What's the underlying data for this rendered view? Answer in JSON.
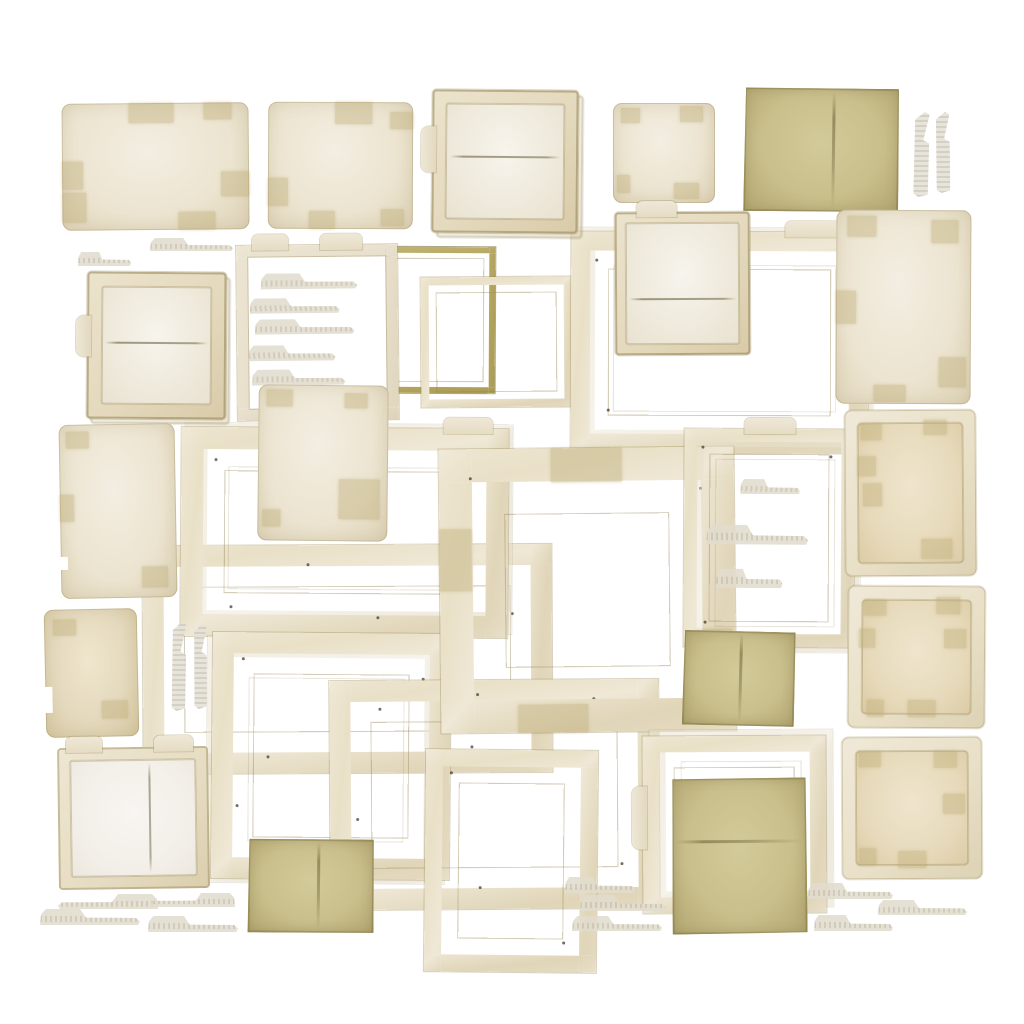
{
  "palette": {
    "white": "#ffffff",
    "cream": "#ece4d0",
    "cream-light": "#f3eee2",
    "cream-dark": "#ddd2b6",
    "tan": "#e4d9bd",
    "pale": "#f5f2ea",
    "olive": "#c9bf8c",
    "olive-dark": "#a89b60",
    "tape": "#bca973",
    "edge": "#98895a",
    "speck": "#3f3826"
  },
  "canvas": {
    "width": 1024,
    "height": 1024
  },
  "items": [
    {
      "id": "frame-wide-left",
      "t": "frame",
      "x": 143,
      "y": 545,
      "w": 367,
      "h": 186,
      "r": -0.3,
      "bw": 21,
      "specks": [
        [
          6,
          20
        ],
        [
          40,
          8
        ],
        [
          90,
          30
        ],
        [
          30,
          92
        ],
        [
          80,
          88
        ]
      ]
    },
    {
      "id": "frame-landscape-mid",
      "t": "frame",
      "x": 181,
      "y": 428,
      "w": 283,
      "h": 165,
      "r": 0.4,
      "bw": 22,
      "tt": [
        [
          80,
          15
        ]
      ],
      "stack": [
        4,
        -4
      ],
      "specks": [
        [
          10,
          15
        ],
        [
          85,
          10
        ],
        [
          15,
          85
        ],
        [
          60,
          90
        ]
      ]
    },
    {
      "id": "frame-square-lower-left",
      "t": "frame",
      "x": 212,
      "y": 633,
      "w": 196,
      "h": 204,
      "r": 0.5,
      "bw": 21,
      "stack": [
        -5,
        4
      ],
      "specks": [
        [
          12,
          10
        ],
        [
          88,
          18
        ],
        [
          10,
          70
        ],
        [
          55,
          92
        ]
      ]
    },
    {
      "id": "frame-landscape-lower",
      "t": "frame",
      "x": 330,
      "y": 680,
      "w": 287,
      "h": 187,
      "r": -0.4,
      "bw": 21,
      "specks": [
        [
          15,
          12
        ],
        [
          80,
          8
        ],
        [
          8,
          60
        ],
        [
          88,
          80
        ],
        [
          45,
          90
        ]
      ]
    },
    {
      "id": "frame-portrait-lower",
      "t": "frame",
      "x": 425,
      "y": 750,
      "w": 138,
      "h": 188,
      "r": 0.6,
      "bw": 17,
      "specks": [
        [
          14,
          10
        ],
        [
          80,
          86
        ]
      ]
    },
    {
      "id": "frame-thin-olive",
      "t": "frame",
      "x": 384,
      "y": 247,
      "w": 99,
      "h": 134,
      "r": 0.3,
      "bw": 6,
      "tone": "olive"
    },
    {
      "id": "frame-thin-cream",
      "t": "frame",
      "x": 421,
      "y": 277,
      "w": 135,
      "h": 114,
      "r": -0.4,
      "bw": 8
    },
    {
      "id": "frame-top-center",
      "t": "frame",
      "x": 571,
      "y": 232,
      "w": 259,
      "h": 183,
      "r": 0.2,
      "bw": 19,
      "tt": [
        [
          72,
          19
        ]
      ],
      "stack": [
        5,
        -4
      ],
      "specks": [
        [
          8,
          12
        ],
        [
          90,
          20
        ],
        [
          12,
          80
        ],
        [
          70,
          92
        ],
        [
          94,
          70
        ]
      ]
    },
    {
      "id": "frame-wide-border",
      "t": "frame",
      "x": 440,
      "y": 448,
      "w": 229,
      "h": 218,
      "r": -0.6,
      "bw": 33,
      "patches": [
        [
          38,
          0,
          24,
          12
        ],
        [
          0,
          28,
          11,
          22
        ],
        [
          84,
          64,
          15,
          20
        ],
        [
          26,
          90,
          24,
          10
        ]
      ],
      "specks": [
        [
          10,
          10
        ],
        [
          88,
          14
        ],
        [
          12,
          86
        ],
        [
          86,
          84
        ]
      ]
    },
    {
      "id": "frame-portrait-tabs",
      "t": "frame",
      "x": 684,
      "y": 429,
      "w": 144,
      "h": 192,
      "r": 0.3,
      "bw": 13,
      "tt": [
        [
          35,
          30
        ]
      ],
      "stack": [
        6,
        5
      ],
      "strips": [
        [
          33,
          23,
          35,
          7
        ],
        [
          13,
          44,
          60,
          9
        ],
        [
          19,
          64,
          39,
          9
        ]
      ],
      "specks": [
        [
          10,
          8
        ],
        [
          85,
          12
        ],
        [
          12,
          88
        ]
      ]
    },
    {
      "id": "frame-folder-stack",
      "t": "frame",
      "x": 643,
      "y": 736,
      "w": 151,
      "h": 145,
      "r": -0.3,
      "bw": 16,
      "st": [
        28,
        36
      ],
      "stack": [
        7,
        -6
      ]
    },
    {
      "id": "card-top-1",
      "t": "card",
      "x": 62,
      "y": 103,
      "w": 187,
      "h": 127,
      "r": -0.5,
      "patches": [
        [
          36,
          0,
          24,
          16
        ],
        [
          76,
          0,
          15,
          13
        ],
        [
          0,
          46,
          11,
          22
        ],
        [
          0,
          70,
          13,
          24
        ],
        [
          85,
          54,
          15,
          20
        ],
        [
          62,
          86,
          20,
          14
        ]
      ]
    },
    {
      "id": "card-top-2",
      "t": "card",
      "x": 268,
      "y": 102,
      "w": 145,
      "h": 127,
      "r": 0.2,
      "patches": [
        [
          46,
          0,
          26,
          17
        ],
        [
          84,
          8,
          16,
          13
        ],
        [
          0,
          60,
          14,
          22
        ],
        [
          28,
          86,
          18,
          14
        ],
        [
          78,
          84,
          16,
          14
        ]
      ]
    },
    {
      "id": "pocket-folder-top",
      "t": "pocket",
      "x": 432,
      "y": 90,
      "w": 146,
      "h": 143,
      "r": 0.5,
      "pw": 14,
      "crease": 45,
      "st": [
        26,
        32
      ],
      "stack": [
        5,
        5
      ]
    },
    {
      "id": "card-top-3",
      "t": "card",
      "x": 613,
      "y": 103,
      "w": 102,
      "h": 100,
      "r": 0,
      "patches": [
        [
          8,
          5,
          18,
          15
        ],
        [
          66,
          3,
          22,
          16
        ],
        [
          4,
          72,
          13,
          18
        ],
        [
          60,
          80,
          24,
          16
        ]
      ]
    },
    {
      "id": "paper-olive-top",
      "t": "paper",
      "x": 744,
      "y": 88,
      "w": 155,
      "h": 124,
      "r": 0.8,
      "fold": [
        "v",
        57
      ]
    },
    {
      "id": "vtab-top-1",
      "t": "vtab",
      "x": 914,
      "y": 112,
      "w": 15,
      "h": 85,
      "r": 1
    },
    {
      "id": "vtab-top-2",
      "t": "vtab",
      "x": 936,
      "y": 112,
      "w": 14,
      "h": 81,
      "r": -1
    },
    {
      "id": "tab-upper-1",
      "t": "tab",
      "x": 150,
      "y": 238,
      "w": 83,
      "h": 13,
      "r": 0
    },
    {
      "id": "tab-upper-2",
      "t": "tab",
      "x": 78,
      "y": 252,
      "w": 53,
      "h": 14,
      "r": 0
    },
    {
      "id": "pocket-folder-left",
      "t": "pocket",
      "x": 87,
      "y": 272,
      "w": 139,
      "h": 147,
      "r": 0.4,
      "pw": 15,
      "crease": 47,
      "st": [
        30,
        28
      ],
      "stack": [
        4,
        5
      ]
    },
    {
      "id": "doc-tab-sheet",
      "t": "doc",
      "x": 237,
      "y": 245,
      "w": 137,
      "h": 151,
      "r": -0.6,
      "bw": 12,
      "tt": [
        [
          10,
          22
        ],
        [
          52,
          26
        ]
      ],
      "strips": [
        [
          15,
          16,
          60,
          9
        ],
        [
          8,
          30,
          56,
          9
        ],
        [
          11,
          42,
          62,
          9
        ],
        [
          7,
          57,
          54,
          9
        ],
        [
          9,
          71,
          58,
          9
        ]
      ]
    },
    {
      "id": "pocket-folder-center",
      "t": "pocket",
      "x": 615,
      "y": 212,
      "w": 135,
      "h": 143,
      "r": -0.3,
      "pw": 11,
      "crease": 62,
      "tt": [
        [
          16,
          30
        ]
      ]
    },
    {
      "id": "card-right-portrait",
      "t": "card",
      "x": 836,
      "y": 210,
      "w": 135,
      "h": 194,
      "r": 0.3,
      "patches": [
        [
          8,
          3,
          22,
          11
        ],
        [
          70,
          5,
          20,
          12
        ],
        [
          0,
          42,
          15,
          17
        ],
        [
          76,
          76,
          20,
          15
        ],
        [
          28,
          90,
          24,
          9
        ]
      ]
    },
    {
      "id": "card-mid-left",
      "t": "card",
      "x": 60,
      "y": 424,
      "w": 116,
      "h": 174,
      "r": -1,
      "patches": [
        [
          6,
          4,
          20,
          10
        ],
        [
          0,
          40,
          12,
          16
        ],
        [
          70,
          82,
          22,
          12
        ]
      ],
      "notches": [
        76
      ]
    },
    {
      "id": "card-center-portrait",
      "t": "card",
      "x": 258,
      "y": 385,
      "w": 130,
      "h": 156,
      "r": 0.6,
      "patches": [
        [
          6,
          3,
          20,
          11
        ],
        [
          66,
          5,
          18,
          10
        ],
        [
          62,
          60,
          32,
          26
        ],
        [
          4,
          80,
          14,
          11
        ]
      ]
    },
    {
      "id": "inset-folder-right-1",
      "t": "inset",
      "x": 845,
      "y": 410,
      "w": 131,
      "h": 166,
      "r": -0.4,
      "pw": 13,
      "patches": [
        [
          12,
          8,
          16,
          10
        ],
        [
          60,
          6,
          18,
          9
        ],
        [
          10,
          28,
          14,
          12
        ],
        [
          14,
          44,
          14,
          14
        ],
        [
          58,
          78,
          24,
          12
        ]
      ]
    },
    {
      "id": "card-left-tan",
      "t": "card",
      "x": 45,
      "y": 609,
      "w": 93,
      "h": 128,
      "r": -1.2,
      "tone": "tan",
      "patches": [
        [
          10,
          8,
          24,
          12
        ],
        [
          60,
          72,
          28,
          14
        ]
      ],
      "notches": [
        60,
        70
      ]
    },
    {
      "id": "vtab-mid-1",
      "t": "vtab",
      "x": 172,
      "y": 622,
      "w": 14,
      "h": 89,
      "r": 0.5
    },
    {
      "id": "vtab-mid-2",
      "t": "vtab",
      "x": 194,
      "y": 624,
      "w": 13,
      "h": 85,
      "r": -0.5
    },
    {
      "id": "paper-olive-center",
      "t": "paper",
      "x": 683,
      "y": 631,
      "w": 112,
      "h": 95,
      "r": 1.5,
      "fold": [
        "v",
        50
      ]
    },
    {
      "id": "inset-folder-right-2",
      "t": "inset",
      "x": 848,
      "y": 586,
      "w": 137,
      "h": 142,
      "r": 0.4,
      "pw": 14,
      "patches": [
        [
          12,
          10,
          16,
          11
        ],
        [
          64,
          8,
          18,
          12
        ],
        [
          8,
          30,
          12,
          14
        ],
        [
          70,
          30,
          16,
          14
        ],
        [
          44,
          80,
          20,
          12
        ],
        [
          14,
          80,
          12,
          12
        ]
      ]
    },
    {
      "id": "paper-olive-big",
      "t": "paper",
      "x": 672,
      "y": 778,
      "w": 135,
      "h": 156,
      "r": -0.5,
      "fold": [
        "h",
        40
      ]
    },
    {
      "id": "inset-folder-right-3",
      "t": "inset",
      "x": 842,
      "y": 737,
      "w": 140,
      "h": 142,
      "r": -0.3,
      "pw": 14,
      "patches": [
        [
          12,
          10,
          16,
          11
        ],
        [
          66,
          10,
          16,
          12
        ],
        [
          72,
          40,
          16,
          14
        ],
        [
          12,
          78,
          12,
          12
        ],
        [
          40,
          80,
          20,
          12
        ]
      ]
    },
    {
      "id": "open-book-folder",
      "t": "book",
      "x": 58,
      "y": 747,
      "w": 151,
      "h": 142,
      "r": -0.8,
      "pw": 13,
      "spine": 62,
      "tt": [
        [
          6,
          24
        ],
        [
          64,
          26
        ]
      ]
    },
    {
      "id": "paper-olive-small",
      "t": "paper",
      "x": 248,
      "y": 839,
      "w": 126,
      "h": 94,
      "r": 0.6,
      "fold": [
        "v",
        55
      ]
    },
    {
      "id": "tab-bl-1",
      "t": "tab",
      "x": 58,
      "y": 894,
      "w": 100,
      "h": 15,
      "r": 0,
      "flip": true
    },
    {
      "id": "tab-bl-2",
      "t": "tab",
      "x": 150,
      "y": 893,
      "w": 85,
      "h": 14,
      "r": 0,
      "flip": true
    },
    {
      "id": "tab-bl-3",
      "t": "tab",
      "x": 40,
      "y": 909,
      "w": 100,
      "h": 16,
      "r": 0
    },
    {
      "id": "tab-bl-4",
      "t": "tab",
      "x": 148,
      "y": 916,
      "w": 90,
      "h": 16,
      "r": 0
    },
    {
      "id": "tab-bm-1",
      "t": "tab",
      "x": 565,
      "y": 877,
      "w": 70,
      "h": 16,
      "r": 0
    },
    {
      "id": "tab-bm-2",
      "t": "tab",
      "x": 580,
      "y": 895,
      "w": 86,
      "h": 16,
      "r": 0
    },
    {
      "id": "tab-bm-3",
      "t": "tab",
      "x": 572,
      "y": 916,
      "w": 90,
      "h": 15,
      "r": 0
    },
    {
      "id": "tab-br-1",
      "t": "tab",
      "x": 808,
      "y": 883,
      "w": 85,
      "h": 16,
      "r": 0
    },
    {
      "id": "tab-br-2",
      "t": "tab",
      "x": 878,
      "y": 900,
      "w": 89,
      "h": 15,
      "r": 0
    },
    {
      "id": "tab-br-3",
      "t": "tab",
      "x": 814,
      "y": 915,
      "w": 79,
      "h": 16,
      "r": 0
    }
  ]
}
